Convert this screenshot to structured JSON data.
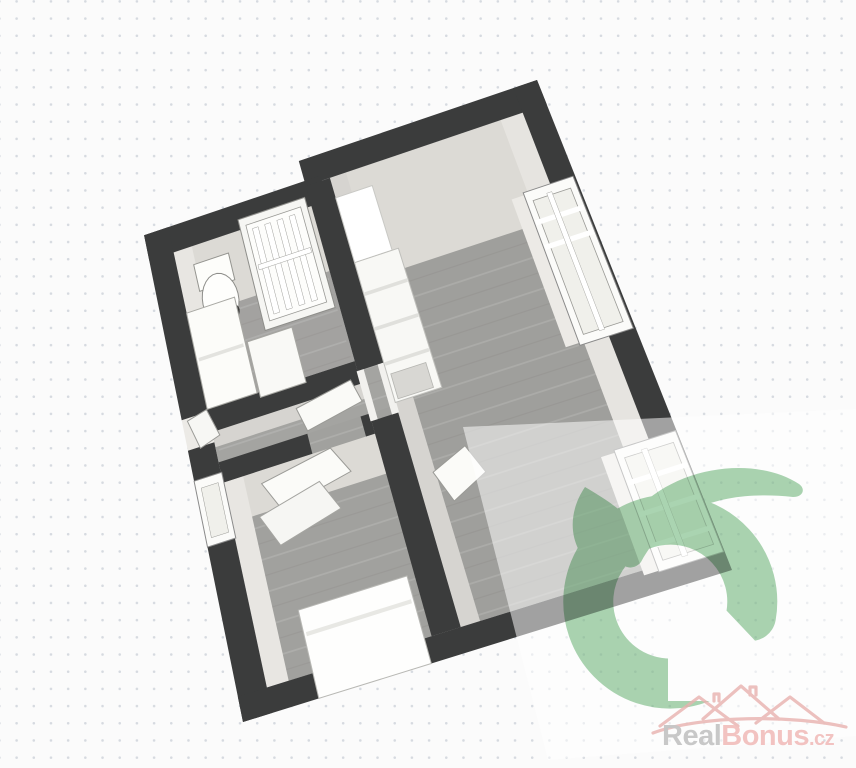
{
  "watermark": {
    "brand": {
      "gray_part": "Real",
      "pink_part": "Bonus",
      "suffix": ".cz"
    }
  },
  "colors": {
    "wall": "#3b3c3c",
    "floor_wood": "#9f9f9c",
    "wall_face_far": "#dcdad5",
    "wall_face_side": "#e8e6e2",
    "furniture_white": "#fdfdfa",
    "logo_green": "#a3d1ab",
    "logo_house": "#fdfdfd",
    "overlay_white": "rgba(255,255,255,0.52)",
    "rooftop_pink": "#e9b2af",
    "brand_gray": "#c6c6c6",
    "brand_pink": "#f2c0be",
    "background": "#fbfbfb",
    "dot_grid": "#d6dae0"
  },
  "plan": {
    "quad": [
      [
        140,
        215
      ],
      [
        537,
        80
      ],
      [
        732,
        570
      ],
      [
        243,
        722
      ]
    ],
    "plank_light": "rgba(255,255,255,0.13)",
    "plank_dark": "rgba(60,56,50,0.06)",
    "elements": [
      {
        "n": "bathroom-floor",
        "t": "rect",
        "uv": [
          0.06,
          0.09,
          0.4,
          0.4
        ],
        "f": "#a3a2a0",
        "planks": true
      },
      {
        "n": "hallway-floor",
        "t": "rect",
        "uv": [
          0.06,
          0.4,
          0.46,
          0.52
        ],
        "f": "#a4a4a1",
        "planks": true
      },
      {
        "n": "bedroom-floor",
        "t": "rect",
        "uv": [
          0.06,
          0.505,
          0.46,
          0.95
        ],
        "f": "#a1a19e",
        "planks": true
      },
      {
        "n": "main-room-floor",
        "t": "rect",
        "uv": [
          0.46,
          0.05,
          0.94,
          0.95
        ],
        "f": "#9f9f9c",
        "planks": true
      },
      {
        "n": "entrance-threshold",
        "t": "rect",
        "uv": [
          0.0,
          0.405,
          0.06,
          0.465
        ],
        "f": "#eceae6"
      },
      {
        "n": "bathroom-wall-face-top",
        "t": "rect",
        "uv": [
          0.06,
          0.09,
          0.4,
          0.22
        ],
        "f": "#dcdad5"
      },
      {
        "n": "bathroom-wall-face-left",
        "t": "rect",
        "uv": [
          0.06,
          0.09,
          0.105,
          0.4
        ],
        "f": "#e8e6e2"
      },
      {
        "n": "main-wall-face-top",
        "t": "rect",
        "uv": [
          0.46,
          0.05,
          0.94,
          0.26
        ],
        "f": "#dcdad5"
      },
      {
        "n": "main-wall-face-right",
        "t": "rect",
        "uv": [
          0.885,
          0.05,
          0.94,
          0.95
        ],
        "f": "#e6e4e0"
      },
      {
        "n": "main-wall-face-divider",
        "t": "rect",
        "uv": [
          0.46,
          0.05,
          0.5,
          0.95
        ],
        "f": "#d6d4d0"
      },
      {
        "n": "bedroom-wall-face-top",
        "t": "rect",
        "uv": [
          0.06,
          0.545,
          0.4,
          0.625
        ],
        "f": "#dcdad5"
      },
      {
        "n": "bedroom-wall-face-left",
        "t": "rect",
        "uv": [
          0.06,
          0.545,
          0.105,
          0.95
        ],
        "f": "#e8e6e2"
      },
      {
        "n": "hallway-wall-face-top",
        "t": "rect",
        "uv": [
          0.06,
          0.445,
          0.4,
          0.475
        ],
        "f": "#d6d4d0"
      },
      {
        "n": "wall-top-main",
        "t": "rect",
        "uv": [
          0.4,
          0.0,
          1.0,
          0.05
        ],
        "f": "#3b3c3c"
      },
      {
        "n": "wall-top-bathroom",
        "t": "rect",
        "uv": [
          0.0,
          0.04,
          0.44,
          0.09
        ],
        "f": "#3b3c3c"
      },
      {
        "n": "wall-left-upper",
        "t": "rect",
        "uv": [
          0.0,
          0.04,
          0.06,
          0.405
        ],
        "f": "#3b3c3c"
      },
      {
        "n": "wall-left-lower",
        "t": "rect",
        "uv": [
          0.0,
          0.465,
          0.06,
          1.0
        ],
        "f": "#3b3c3c"
      },
      {
        "n": "wall-bottom",
        "t": "rect",
        "uv": [
          0.0,
          0.95,
          1.0,
          1.0
        ],
        "f": "#3b3c3c"
      },
      {
        "n": "wall-right",
        "t": "rect",
        "uv": [
          0.94,
          0.0,
          1.0,
          0.95
        ],
        "f": "#3b3c3c"
      },
      {
        "n": "wall-divider-upper",
        "t": "rect",
        "uv": [
          0.4,
          0.05,
          0.46,
          0.42
        ],
        "f": "#3b3c3c"
      },
      {
        "n": "wall-divider-lower",
        "t": "rect",
        "uv": [
          0.4,
          0.52,
          0.46,
          0.95
        ],
        "f": "#3b3c3c"
      },
      {
        "n": "wall-bathroom-bottom",
        "t": "rect",
        "uv": [
          0.06,
          0.4,
          0.4,
          0.445
        ],
        "f": "#3b3c3c"
      },
      {
        "n": "wall-bedroom-top-left",
        "t": "rect",
        "uv": [
          0.06,
          0.505,
          0.26,
          0.545
        ],
        "f": "#3b3c3c"
      },
      {
        "n": "wall-bedroom-top-right",
        "t": "rect",
        "uv": [
          0.38,
          0.505,
          0.4,
          0.545
        ],
        "f": "#3b3c3c"
      },
      {
        "n": "door-frame-hall-left",
        "t": "rect",
        "uv": [
          0.398,
          0.42,
          0.414,
          0.52
        ],
        "f": "#f2f1ee"
      },
      {
        "n": "door-frame-hall-right",
        "t": "rect",
        "uv": [
          0.446,
          0.42,
          0.462,
          0.52
        ],
        "f": "#f2f1ee"
      },
      {
        "n": "window-sill-upper",
        "t": "rect",
        "uv": [
          0.845,
          0.2,
          0.885,
          0.5
        ],
        "f": "#eceae6"
      },
      {
        "n": "window-upper-frame",
        "t": "rect",
        "uv": [
          0.875,
          0.195,
          0.995,
          0.505
        ],
        "f": "#fbfbf9",
        "s": "#8a8a8a",
        "w": 1
      },
      {
        "n": "window-upper-pane",
        "t": "rect",
        "uv": [
          0.89,
          0.215,
          0.98,
          0.487
        ],
        "f": "#f0f0eb",
        "s": "#9a9a96",
        "w": 0.8
      },
      {
        "n": "window-upper-bar-1",
        "t": "rect",
        "uv": [
          0.878,
          0.252,
          0.992,
          0.262
        ],
        "f": "#ffffff"
      },
      {
        "n": "window-upper-bar-2",
        "t": "rect",
        "uv": [
          0.878,
          0.302,
          0.992,
          0.312
        ],
        "f": "#ffffff"
      },
      {
        "n": "window-upper-bar-vertical",
        "t": "rect",
        "uv": [
          0.925,
          0.21,
          0.937,
          0.49
        ],
        "f": "#ffffff",
        "s": "#aaaaa6",
        "w": 0.5
      },
      {
        "n": "window-sill-lower",
        "t": "rect",
        "uv": [
          0.835,
          0.72,
          0.875,
          0.96
        ],
        "f": "#eceae6"
      },
      {
        "n": "window-lower-frame",
        "t": "rect",
        "uv": [
          0.865,
          0.715,
          0.998,
          0.962
        ],
        "f": "#fbfbf9",
        "s": "#8a8a8a",
        "w": 1
      },
      {
        "n": "window-lower-pane",
        "t": "rect",
        "uv": [
          0.88,
          0.735,
          0.985,
          0.943
        ],
        "f": "#f0f0eb",
        "s": "#9a9a96",
        "w": 0.8
      },
      {
        "n": "window-lower-bar-1",
        "t": "rect",
        "uv": [
          0.868,
          0.778,
          0.995,
          0.788
        ],
        "f": "#ffffff"
      },
      {
        "n": "window-lower-bar-2",
        "t": "rect",
        "uv": [
          0.868,
          0.842,
          0.995,
          0.852
        ],
        "f": "#ffffff"
      },
      {
        "n": "window-lower-bar-3",
        "t": "rect",
        "uv": [
          0.868,
          0.906,
          0.995,
          0.916
        ],
        "f": "#ffffff"
      },
      {
        "n": "window-lower-bar-vertical",
        "t": "rect",
        "uv": [
          0.918,
          0.73,
          0.93,
          0.948
        ],
        "f": "#ffffff",
        "s": "#aaaaa6",
        "w": 0.5
      },
      {
        "n": "kitchen-cabinet-tall",
        "t": "rect",
        "uv": [
          0.46,
          0.09,
          0.55,
          0.22
        ],
        "f": "#ffffff",
        "s": "#c9c9c5",
        "w": 1
      },
      {
        "n": "kitchen-counter",
        "t": "rect",
        "uv": [
          0.46,
          0.22,
          0.565,
          0.5
        ],
        "f": "#f8f8f5",
        "s": "#bfbfbb",
        "w": 1
      },
      {
        "n": "kitchen-counter-seam-1",
        "t": "rect",
        "uv": [
          0.462,
          0.28,
          0.563,
          0.287
        ],
        "f": "#e0e0dc"
      },
      {
        "n": "kitchen-counter-seam-2",
        "t": "rect",
        "uv": [
          0.462,
          0.35,
          0.563,
          0.357
        ],
        "f": "#e0e0dc"
      },
      {
        "n": "kitchen-counter-seam-3",
        "t": "rect",
        "uv": [
          0.462,
          0.42,
          0.563,
          0.427
        ],
        "f": "#e0e0dc"
      },
      {
        "n": "kitchen-appliance",
        "t": "rect",
        "uv": [
          0.468,
          0.445,
          0.548,
          0.495
        ],
        "f": "#d8d7d3",
        "s": "#b5b5b1",
        "w": 0.8
      },
      {
        "n": "shower-frame",
        "t": "rect",
        "uv": [
          0.225,
          0.07,
          0.39,
          0.29
        ],
        "f": "#f6f6f3",
        "s": "#8e8e8a",
        "w": 1
      },
      {
        "n": "shower-glass",
        "t": "rect",
        "uv": [
          0.24,
          0.085,
          0.375,
          0.275
        ],
        "f": "#fdfdfb",
        "s": "#9a9a96",
        "w": 0.8
      },
      {
        "n": "shower-bar-1",
        "t": "rect",
        "uv": [
          0.253,
          0.095,
          0.267,
          0.265
        ],
        "f": "#ffffff",
        "s": "#a0a09c",
        "w": 0.5
      },
      {
        "n": "shower-bar-2",
        "t": "rect",
        "uv": [
          0.283,
          0.095,
          0.297,
          0.265
        ],
        "f": "#ffffff",
        "s": "#a0a09c",
        "w": 0.5
      },
      {
        "n": "shower-bar-3",
        "t": "rect",
        "uv": [
          0.313,
          0.095,
          0.327,
          0.265
        ],
        "f": "#ffffff",
        "s": "#a0a09c",
        "w": 0.5
      },
      {
        "n": "shower-bar-4",
        "t": "rect",
        "uv": [
          0.343,
          0.095,
          0.357,
          0.265
        ],
        "f": "#ffffff",
        "s": "#a0a09c",
        "w": 0.5
      },
      {
        "n": "shower-rail",
        "t": "rect",
        "uv": [
          0.245,
          0.165,
          0.372,
          0.175
        ],
        "f": "#ffffff",
        "s": "#a0a09c",
        "w": 0.5
      },
      {
        "n": "toilet-tank",
        "t": "rect",
        "uv": [
          0.1,
          0.125,
          0.185,
          0.178
        ],
        "f": "#fdfdfa",
        "s": "#94948f",
        "w": 1
      },
      {
        "n": "toilet-bowl",
        "t": "ellipse",
        "c": [
          0.143,
          0.205
        ],
        "r": [
          0.042,
          0.05
        ],
        "f": "#fefefc",
        "s": "#8e8e8a",
        "w": 1
      },
      {
        "n": "toilet-seat",
        "t": "ellipse",
        "c": [
          0.148,
          0.235
        ],
        "r": [
          0.032,
          0.02
        ],
        "f": "#3f3f3e"
      },
      {
        "n": "vanity-cabinet",
        "t": "rect",
        "uv": [
          0.06,
          0.21,
          0.175,
          0.4
        ],
        "f": "#fcfcf9",
        "s": "#a8a8a3",
        "w": 1
      },
      {
        "n": "vanity-seam",
        "t": "rect",
        "uv": [
          0.065,
          0.3,
          0.17,
          0.307
        ],
        "f": "#e3e3df"
      },
      {
        "n": "washer",
        "t": "rect",
        "uv": [
          0.18,
          0.3,
          0.285,
          0.41
        ],
        "f": "#f9f9f6",
        "s": "#a8a8a3",
        "w": 1
      },
      {
        "n": "desk-panel",
        "t": "poly",
        "pts": [
          [
            0.14,
            0.57
          ],
          [
            0.3,
            0.545
          ],
          [
            0.33,
            0.6
          ],
          [
            0.17,
            0.63
          ]
        ],
        "f": "#fbfbf8",
        "s": "#9b9b97",
        "w": 1
      },
      {
        "n": "desk-panel-2",
        "t": "poly",
        "pts": [
          [
            0.12,
            0.63
          ],
          [
            0.26,
            0.6
          ],
          [
            0.29,
            0.662
          ],
          [
            0.15,
            0.695
          ]
        ],
        "f": "#f6f6f3",
        "s": "#a5a5a1",
        "w": 1
      },
      {
        "n": "bed",
        "t": "rect",
        "uv": [
          0.155,
          0.825,
          0.385,
          1.0
        ],
        "f": "#fefefd",
        "s": "#b8b8b4",
        "w": 1
      },
      {
        "n": "bed-seam",
        "t": "rect",
        "uv": [
          0.16,
          0.87,
          0.38,
          0.878
        ],
        "f": "#e8e8e4"
      },
      {
        "n": "bedroom-window-frame",
        "t": "rect",
        "uv": [
          0.0,
          0.525,
          0.062,
          0.655
        ],
        "f": "#fbfbf9",
        "s": "#8a8a8a",
        "w": 1
      },
      {
        "n": "bedroom-window-pane",
        "t": "rect",
        "uv": [
          0.012,
          0.542,
          0.05,
          0.64
        ],
        "f": "#f0f0eb",
        "s": "#9a9a96",
        "w": 0.5
      },
      {
        "n": "entrance-door-leaf",
        "t": "poly",
        "pts": [
          [
            0.012,
            0.41
          ],
          [
            0.058,
            0.4
          ],
          [
            0.075,
            0.455
          ],
          [
            0.028,
            0.468
          ]
        ],
        "f": "#f7f7f4",
        "s": "#9a9a96",
        "w": 1
      },
      {
        "n": "bedroom-door-leaf",
        "t": "poly",
        "pts": [
          [
            0.25,
            0.452
          ],
          [
            0.38,
            0.432
          ],
          [
            0.392,
            0.478
          ],
          [
            0.262,
            0.5
          ]
        ],
        "f": "#fafaf7",
        "s": "#9a9a96",
        "w": 1
      },
      {
        "n": "main-door-leaf",
        "t": "poly",
        "pts": [
          [
            0.495,
            0.65
          ],
          [
            0.575,
            0.62
          ],
          [
            0.6,
            0.68
          ],
          [
            0.52,
            0.715
          ]
        ],
        "f": "#fbfbf8",
        "s": "#9a9a96",
        "w": 1
      }
    ]
  }
}
